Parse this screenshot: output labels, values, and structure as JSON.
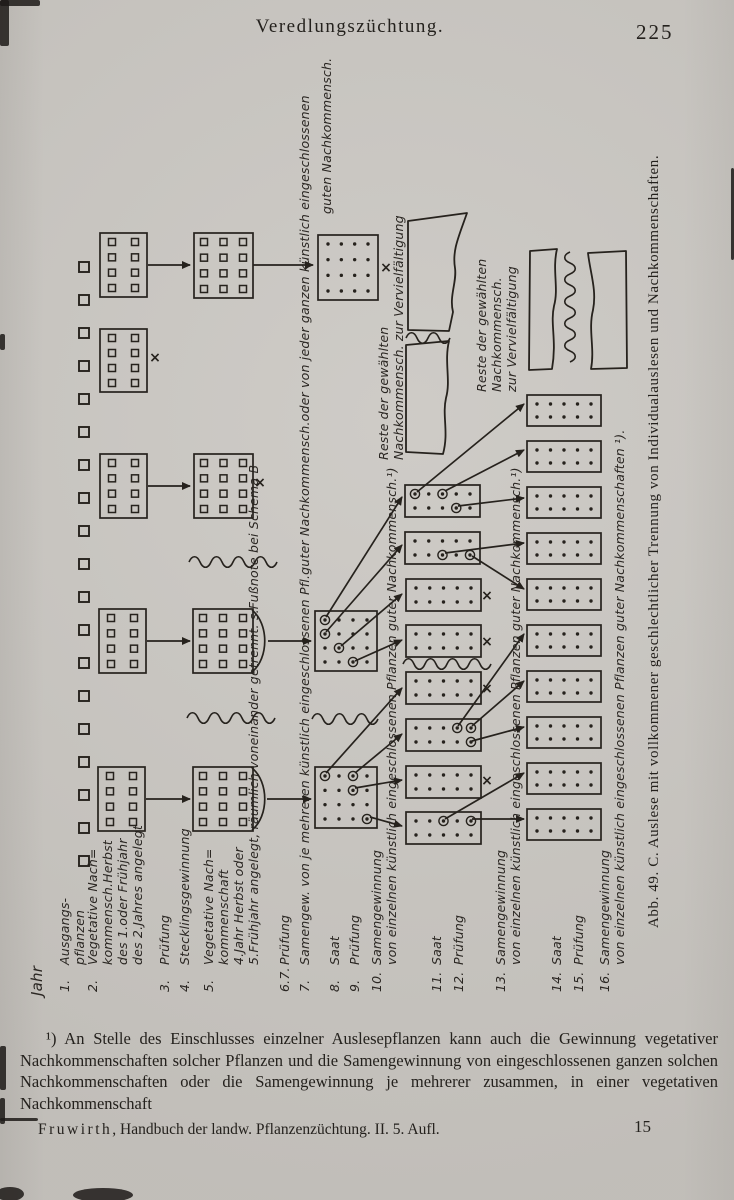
{
  "paper_color": "#cac7c2",
  "ink_color": "#26221d",
  "header": {
    "title": "Veredlungszüchtung.",
    "page_number": "225"
  },
  "figure": {
    "caption": "Abb. 49.   C. Auslese mit vollkommener geschlechtlicher Trennung von Individualauslesen und Nachkommenschaften.",
    "year_rows": [
      {
        "num": "",
        "lines": [
          "Jahr"
        ],
        "x": 30,
        "y": 996,
        "big": true
      },
      {
        "num": "1.",
        "lines": [
          "Ausgangs-",
          "pflanzen"
        ],
        "x": 57,
        "y": 992
      },
      {
        "num": "2.",
        "lines": [
          "Vegetative Nach=",
          "kommensch.Herbst",
          "des 1.oder Frühjahr",
          "des 2.Jahres angelegt"
        ],
        "x": 85,
        "y": 992
      },
      {
        "num": "3.",
        "lines": [
          "Prüfung"
        ],
        "x": 157,
        "y": 992
      },
      {
        "num": "4.",
        "lines": [
          "Stecklingsgewinnung"
        ],
        "x": 177,
        "y": 992
      },
      {
        "num": "5.",
        "lines": [
          "Vegetative Nach=",
          "kommenschaft",
          "4.Jahr Herbst oder",
          "5.Frühjahr angelegt, räumlich voneinander getrennt. s.Fußnote bei  Schema B"
        ],
        "x": 201,
        "y": 992
      },
      {
        "num": "6.7.",
        "lines": [
          "Prüfung"
        ],
        "x": 277,
        "y": 992
      },
      {
        "num": "7.",
        "lines": [
          "Samengew. von je mehreren  künstlich eingeschlossenen Pfl.guter Nachkommensch.oder von jeder ganzen künstlich eingeschlossenen"
        ],
        "x": 297,
        "y": 992
      },
      {
        "num": "8.",
        "lines": [
          "Saat"
        ],
        "x": 327,
        "y": 992
      },
      {
        "num": "9.",
        "lines": [
          "Prüfung"
        ],
        "x": 347,
        "y": 992
      },
      {
        "num": "10.",
        "lines": [
          "Samengewinnung",
          "von einzelnen künstlich eingeschlossenen Pflanzen guter Nachkommensch.¹)"
        ],
        "x": 369,
        "y": 992
      },
      {
        "num": "11.",
        "lines": [
          "Saat"
        ],
        "x": 429,
        "y": 992
      },
      {
        "num": "12.",
        "lines": [
          "Prüfung"
        ],
        "x": 451,
        "y": 992
      },
      {
        "num": "13.",
        "lines": [
          "Samengewinnung",
          "von einzelnen künstlich eingeschlossenen Pflanzen guter Nachkommensch.¹)"
        ],
        "x": 493,
        "y": 992
      },
      {
        "num": "14.",
        "lines": [
          "Saat"
        ],
        "x": 549,
        "y": 992
      },
      {
        "num": "15.",
        "lines": [
          "Prüfung"
        ],
        "x": 571,
        "y": 992
      },
      {
        "num": "16.",
        "lines": [
          "Samengewinnung",
          "von einzelnen künstlich eingeschlossenen Pflanzen guter Nachkommenschaften ¹)."
        ],
        "x": 597,
        "y": 992
      }
    ],
    "annotations": [
      {
        "lines": [
          "guten Nachkommensch."
        ],
        "x": 319,
        "y": 214
      },
      {
        "lines": [
          "Reste der gewählten",
          "Nachkommensch. zur Vervielfältigung"
        ],
        "x": 376,
        "y": 460
      },
      {
        "lines": [
          "Reste der gewählten",
          "Nachkommensch.",
          "zur Vervielfältigung"
        ],
        "x": 474,
        "y": 392
      }
    ],
    "diagram": {
      "cross_symbol": "×",
      "start_plants": {
        "x": 79,
        "size": 10,
        "y_first": 262,
        "step": 33,
        "count": 19
      },
      "boxes": [
        {
          "x": 100,
          "y": 233,
          "w": 47,
          "h": 64,
          "kind": "sq",
          "cols": 2,
          "rows": 4
        },
        {
          "x": 100,
          "y": 329,
          "w": 47,
          "h": 63,
          "kind": "sq",
          "cols": 2,
          "rows": 4
        },
        {
          "x": 100,
          "y": 454,
          "w": 47,
          "h": 64,
          "kind": "sq",
          "cols": 2,
          "rows": 4
        },
        {
          "x": 99,
          "y": 609,
          "w": 47,
          "h": 64,
          "kind": "sq",
          "cols": 2,
          "rows": 4
        },
        {
          "x": 98,
          "y": 767,
          "w": 47,
          "h": 64,
          "kind": "sq",
          "cols": 2,
          "rows": 4
        },
        {
          "x": 194,
          "y": 233,
          "w": 59,
          "h": 65,
          "kind": "sq",
          "cols": 3,
          "rows": 4
        },
        {
          "x": 194,
          "y": 454,
          "w": 59,
          "h": 64,
          "kind": "sq",
          "cols": 3,
          "rows": 4
        },
        {
          "x": 193,
          "y": 609,
          "w": 60,
          "h": 64,
          "kind": "sq",
          "cols": 3,
          "rows": 4
        },
        {
          "x": 193,
          "y": 767,
          "w": 60,
          "h": 64,
          "kind": "sq",
          "cols": 3,
          "rows": 4
        },
        {
          "x": 318,
          "y": 235,
          "w": 60,
          "h": 65,
          "kind": "dot",
          "cols": 4,
          "rows": 4
        },
        {
          "x": 315,
          "y": 611,
          "w": 62,
          "h": 60,
          "kind": "dot",
          "cols": 4,
          "rows": 4,
          "circ": [
            [
              0,
              0
            ],
            [
              0,
              1
            ],
            [
              1,
              2
            ],
            [
              2,
              3
            ]
          ]
        },
        {
          "x": 315,
          "y": 767,
          "w": 62,
          "h": 61,
          "kind": "dot",
          "cols": 4,
          "rows": 4,
          "circ": [
            [
              0,
              0
            ],
            [
              2,
              0
            ],
            [
              2,
              1
            ],
            [
              3,
              3
            ]
          ]
        },
        {
          "x": 405,
          "y": 485,
          "w": 75,
          "h": 32,
          "kind": "dot",
          "cols": 5,
          "rows": 2,
          "circ": [
            [
              0,
              0
            ],
            [
              2,
              0
            ],
            [
              3,
              1
            ]
          ]
        },
        {
          "x": 405,
          "y": 532,
          "w": 75,
          "h": 32,
          "kind": "dot",
          "cols": 5,
          "rows": 2,
          "circ": [
            [
              2,
              1
            ],
            [
              4,
              1
            ]
          ]
        },
        {
          "x": 406,
          "y": 579,
          "w": 75,
          "h": 32,
          "kind": "dot",
          "cols": 5,
          "rows": 2
        },
        {
          "x": 406,
          "y": 625,
          "w": 75,
          "h": 32,
          "kind": "dot",
          "cols": 5,
          "rows": 2
        },
        {
          "x": 406,
          "y": 672,
          "w": 75,
          "h": 32,
          "kind": "dot",
          "cols": 5,
          "rows": 2
        },
        {
          "x": 406,
          "y": 719,
          "w": 75,
          "h": 32,
          "kind": "dot",
          "cols": 5,
          "rows": 2,
          "circ": [
            [
              3,
              0
            ],
            [
              4,
              0
            ],
            [
              4,
              1
            ]
          ]
        },
        {
          "x": 406,
          "y": 766,
          "w": 75,
          "h": 32,
          "kind": "dot",
          "cols": 5,
          "rows": 2
        },
        {
          "x": 406,
          "y": 812,
          "w": 75,
          "h": 32,
          "kind": "dot",
          "cols": 5,
          "rows": 2,
          "circ": [
            [
              2,
              0
            ],
            [
              4,
              0
            ]
          ]
        },
        {
          "x": 527,
          "y": 395,
          "w": 74,
          "h": 31,
          "kind": "dot",
          "cols": 5,
          "rows": 2
        },
        {
          "x": 527,
          "y": 441,
          "w": 74,
          "h": 31,
          "kind": "dot",
          "cols": 5,
          "rows": 2
        },
        {
          "x": 527,
          "y": 487,
          "w": 74,
          "h": 31,
          "kind": "dot",
          "cols": 5,
          "rows": 2
        },
        {
          "x": 527,
          "y": 533,
          "w": 74,
          "h": 31,
          "kind": "dot",
          "cols": 5,
          "rows": 2
        },
        {
          "x": 527,
          "y": 579,
          "w": 74,
          "h": 31,
          "kind": "dot",
          "cols": 5,
          "rows": 2
        },
        {
          "x": 527,
          "y": 625,
          "w": 74,
          "h": 31,
          "kind": "dot",
          "cols": 5,
          "rows": 2
        },
        {
          "x": 527,
          "y": 671,
          "w": 74,
          "h": 31,
          "kind": "dot",
          "cols": 5,
          "rows": 2
        },
        {
          "x": 527,
          "y": 717,
          "w": 74,
          "h": 31,
          "kind": "dot",
          "cols": 5,
          "rows": 2
        },
        {
          "x": 527,
          "y": 763,
          "w": 74,
          "h": 31,
          "kind": "dot",
          "cols": 5,
          "rows": 2
        },
        {
          "x": 527,
          "y": 809,
          "w": 74,
          "h": 31,
          "kind": "dot",
          "cols": 5,
          "rows": 2
        }
      ],
      "arrows": [
        [
          148,
          265,
          190,
          265
        ],
        [
          253,
          265,
          313,
          265
        ],
        [
          148,
          486,
          190,
          486
        ],
        [
          147,
          641,
          190,
          641
        ],
        [
          146,
          799,
          190,
          799
        ],
        [
          268,
          641,
          311,
          641
        ],
        [
          267,
          799,
          311,
          799
        ],
        [
          326,
          617,
          402,
          497
        ],
        [
          326,
          632,
          402,
          545
        ],
        [
          341,
          646,
          402,
          594
        ],
        [
          355,
          661,
          402,
          640
        ],
        [
          326,
          773,
          402,
          688
        ],
        [
          355,
          773,
          402,
          734
        ],
        [
          355,
          788,
          402,
          780
        ],
        [
          370,
          817,
          402,
          826
        ],
        [
          417,
          492,
          524,
          404
        ],
        [
          445,
          491,
          524,
          450
        ],
        [
          458,
          506,
          524,
          498
        ],
        [
          445,
          553,
          524,
          543
        ],
        [
          472,
          556,
          524,
          589
        ],
        [
          458,
          726,
          524,
          634
        ],
        [
          472,
          726,
          524,
          681
        ],
        [
          472,
          741,
          524,
          727
        ],
        [
          445,
          819,
          524,
          773
        ],
        [
          472,
          819,
          524,
          819
        ]
      ],
      "crosses": [
        [
          155,
          358
        ],
        [
          260,
          483
        ],
        [
          386,
          268
        ],
        [
          487,
          596
        ],
        [
          487,
          642
        ],
        [
          487,
          689
        ],
        [
          487,
          781
        ]
      ],
      "squiggles": [
        {
          "x": 189,
          "y": 562,
          "len": 68
        },
        {
          "x": 187,
          "y": 718,
          "len": 72
        },
        {
          "x": 312,
          "y": 719,
          "len": 66
        },
        {
          "x": 403,
          "y": 664,
          "len": 88
        },
        {
          "x": 406,
          "y": 338,
          "len": 42
        },
        {
          "x": 570,
          "y": 252,
          "len": 110,
          "v": 1
        }
      ],
      "lenses": [
        {
          "x": 252,
          "y": 610,
          "h": 62
        },
        {
          "x": 252,
          "y": 768,
          "h": 62
        }
      ],
      "torn_plots": [
        "M408,221 L467,213 C459,236 452,250 455,268 C457,282 449,296 453,312 L449,331 L408,330 Z",
        "M406,345 L449,341 C444,362 451,380 446,398 C442,416 449,432 443,454 L406,452 Z",
        "M530,251 L557,249 C552,270 559,288 554,306 C550,324 557,340 552,369 L529,370 Z",
        "M588,253 L626,251 L627,368 L591,369 C595,348 588,330 593,310 C597,290 590,272 588,253 Z"
      ]
    }
  },
  "footnote": {
    "marker": "¹)",
    "text": " An Stelle des Einschlusses einzelner Auslesepflanzen kann auch die Gewinnung vegetativer Nachkommenschaften solcher Pflanzen und die Samengewinnung von eingeschlossenen ganzen solchen Nachkommenschaften oder die Samengewinnung je mehrerer zusammen, in einer vegetativen Nachkommenschaft"
  },
  "footer": {
    "signature_author": "Fruwirth",
    "signature_rest": ", Handbuch der landw. Pflanzenzüchtung.  II.  5. Aufl.",
    "sheet_number": "15"
  }
}
